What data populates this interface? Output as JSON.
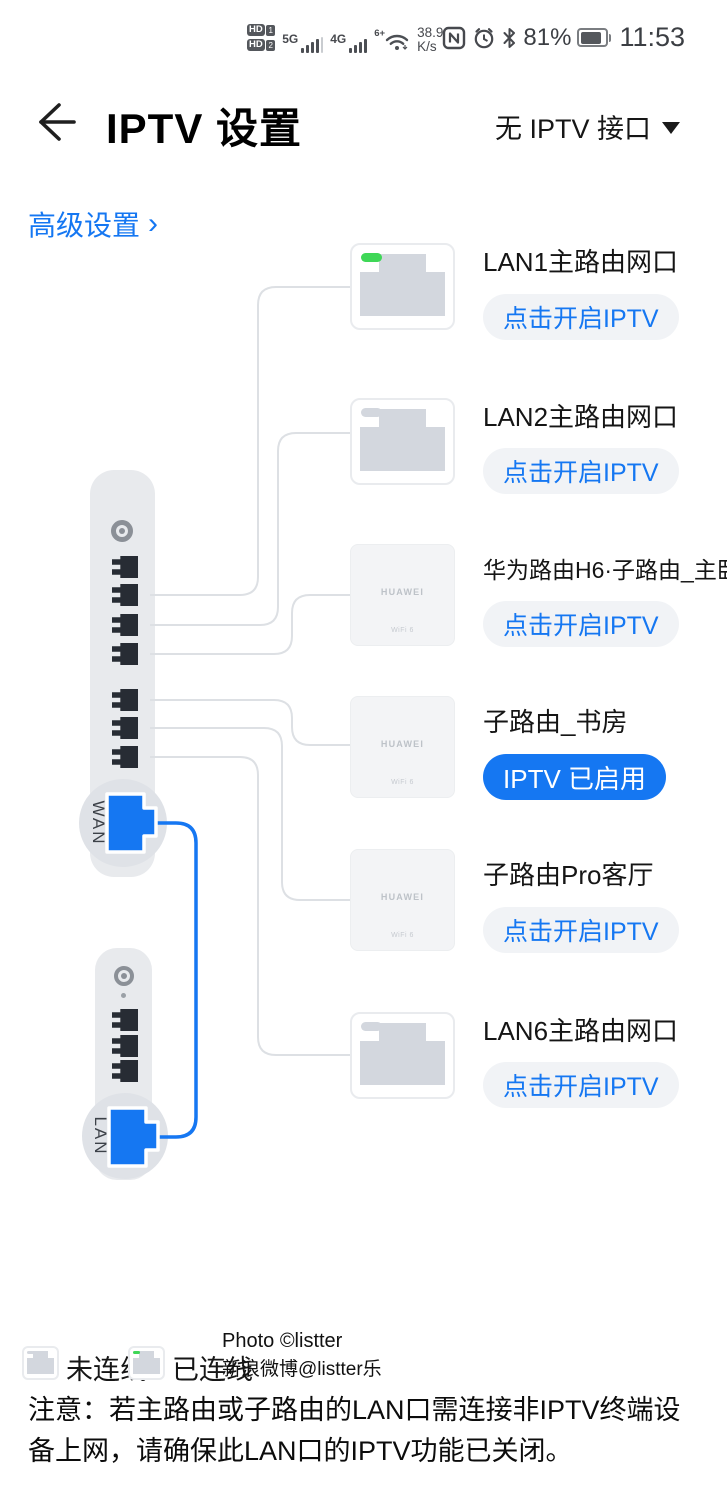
{
  "status_bar": {
    "hd_badge": "HD",
    "sim1": "1",
    "sim2": "2",
    "net_5g": "5G",
    "net_4g": "4G",
    "wifi_gen": "6+",
    "speed": "38.9",
    "speed_unit": "K/s",
    "battery_percent": "81%",
    "time": "11:53"
  },
  "header": {
    "title": "IPTV 设置",
    "selector_label": "无 IPTV 接口"
  },
  "advanced": {
    "label": "高级设置",
    "chevron": "›"
  },
  "router": {
    "wan_label": "WAN"
  },
  "modem": {
    "lan_label": "LAN"
  },
  "brand": {
    "huawei": "HUAWEI",
    "wifi6": "WiFi 6"
  },
  "devices": [
    {
      "label": "LAN1主路由网口",
      "action": "点击开启IPTV",
      "icon": "ethernet-port",
      "connected": true
    },
    {
      "label": "LAN2主路由网口",
      "action": "点击开启IPTV",
      "icon": "ethernet-port",
      "connected": false
    },
    {
      "label": "华为路由H6·子路由_主卧",
      "action": "点击开启IPTV",
      "icon": "huawei-router",
      "connected": true
    },
    {
      "label": "子路由_书房",
      "action": "IPTV 已启用",
      "icon": "huawei-router",
      "connected": true,
      "iptv_enabled": true
    },
    {
      "label": "子路由Pro客厅",
      "action": "点击开启IPTV",
      "icon": "huawei-router",
      "connected": true
    },
    {
      "label": "LAN6主路由网口",
      "action": "点击开启IPTV",
      "icon": "ethernet-port",
      "connected": false
    }
  ],
  "legend": {
    "not_connected": "未连线",
    "connected": "已连线"
  },
  "watermark": {
    "line1": "Photo ©listter",
    "line2": "新浪微博@listter乐"
  },
  "note": "注意：若主路由或子路由的LAN口需连接非IPTV终端设备上网，请确保此LAN口的IPTV功能已关闭。",
  "colors": {
    "accent": "#1577f2",
    "connected_green": "#3fd757",
    "wire": "#dde0e4"
  }
}
